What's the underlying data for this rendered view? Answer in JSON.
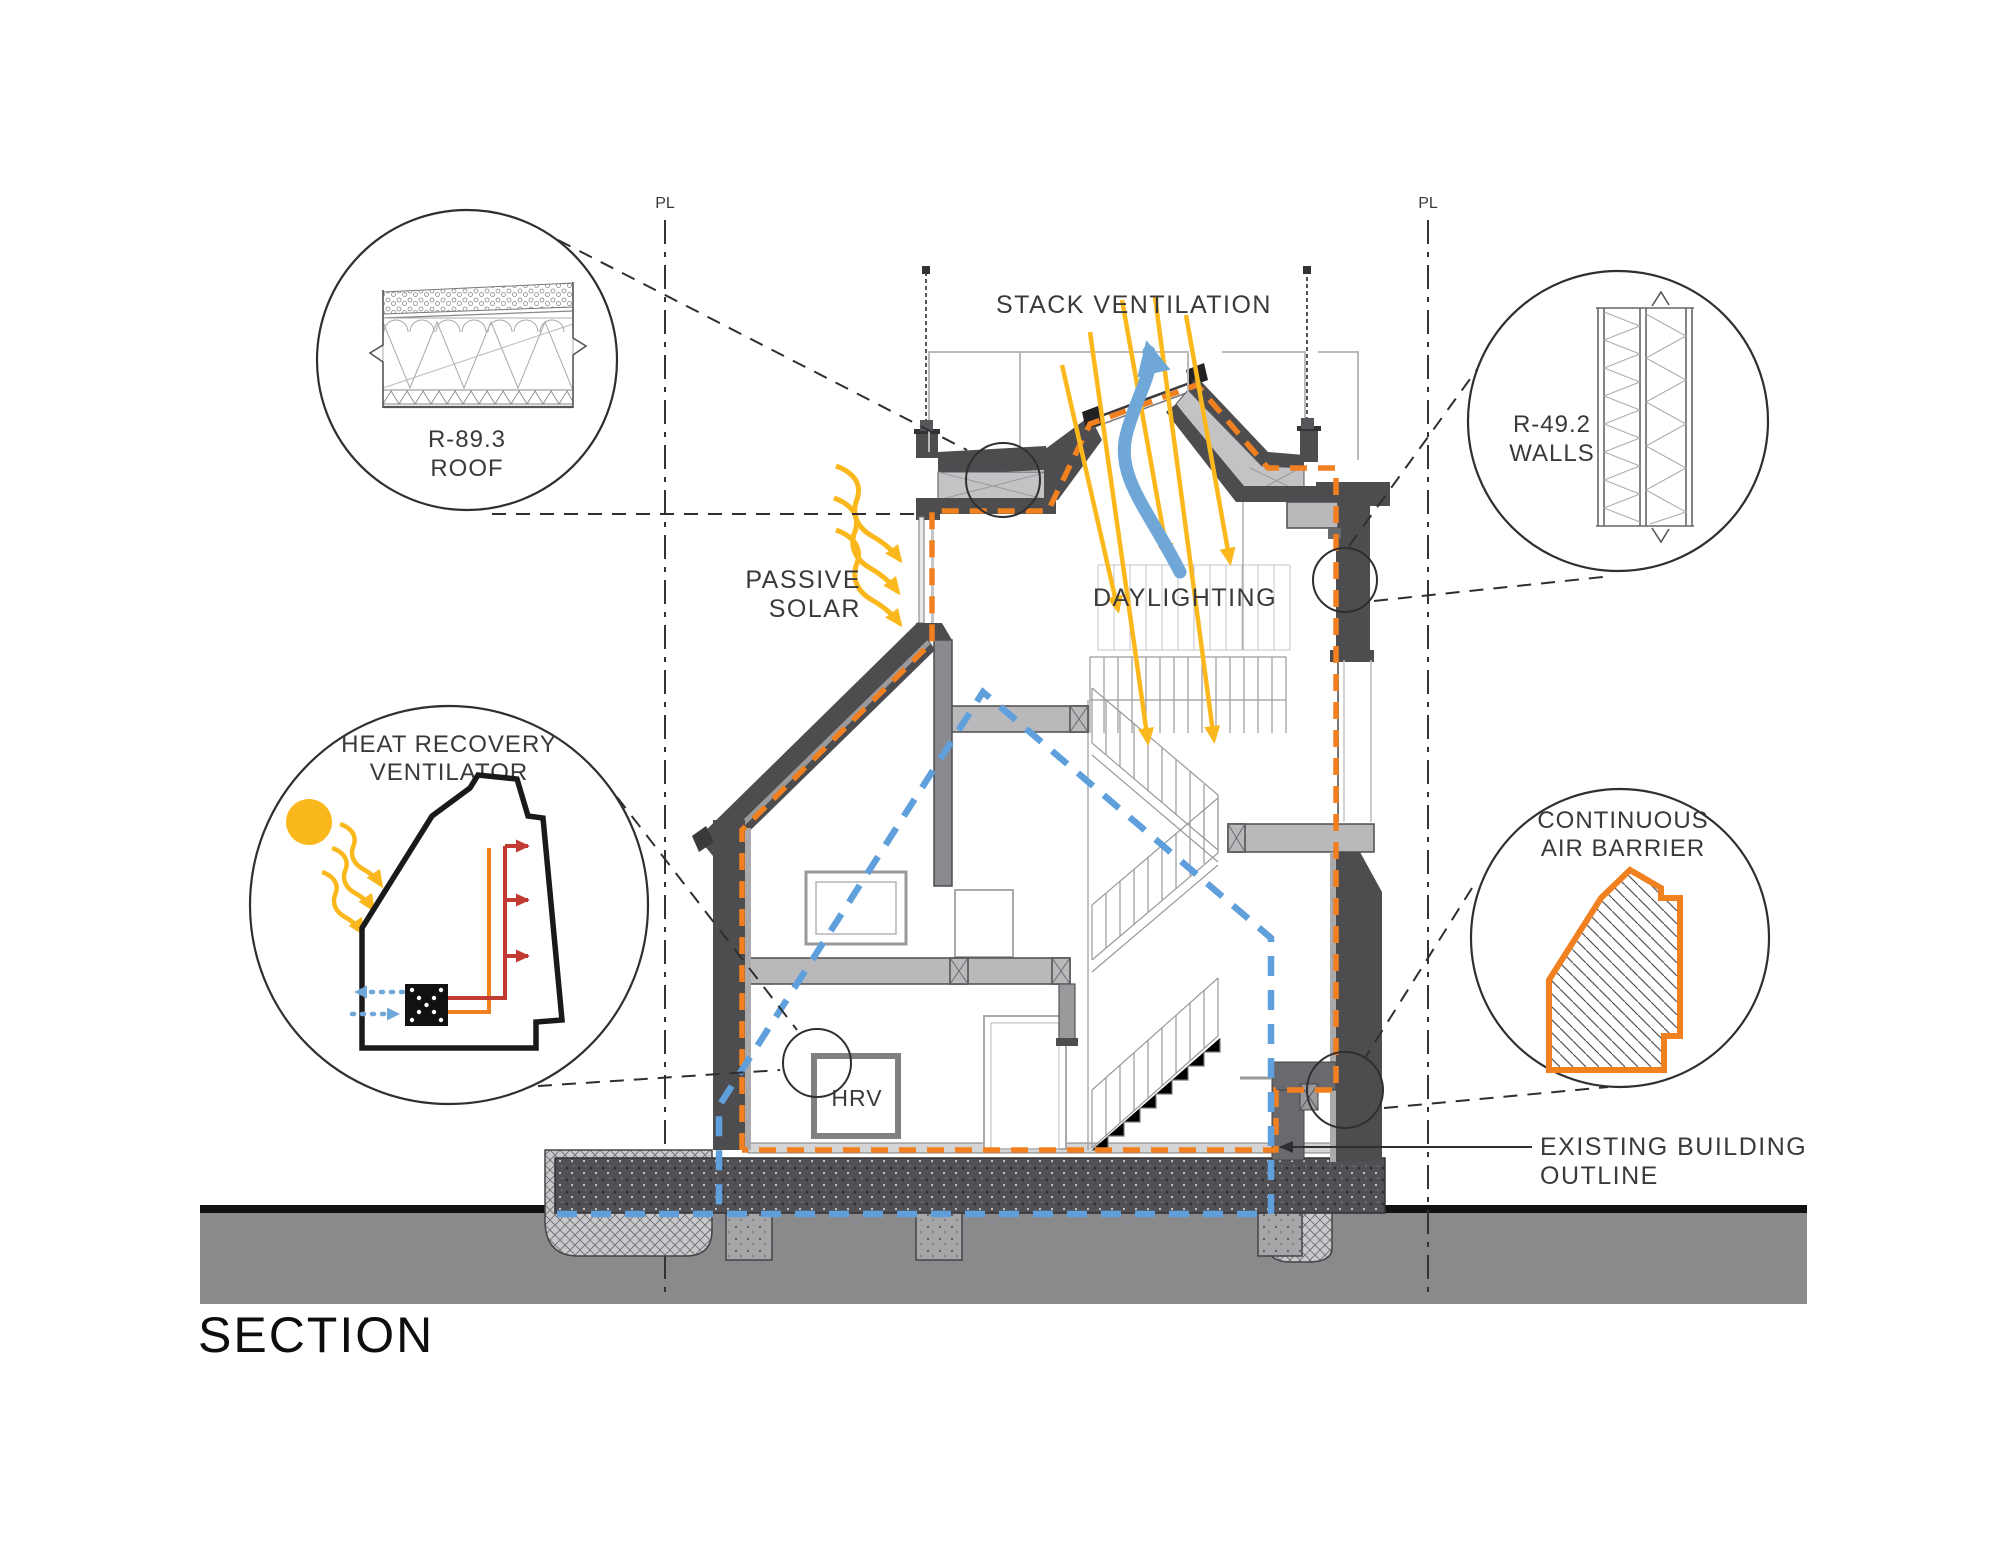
{
  "title": "SECTION",
  "property_line": {
    "label": "PL"
  },
  "annotations": {
    "stack_ventilation": "STACK VENTILATION",
    "passive_solar": {
      "line1": "PASSIVE",
      "line2": "SOLAR"
    },
    "daylighting": "DAYLIGHTING",
    "existing_building": {
      "line1": "EXISTING BUILDING",
      "line2": "OUTLINE"
    },
    "hrv_unit": "HRV"
  },
  "callouts": {
    "roof": {
      "line1": "R-89.3",
      "line2": "ROOF"
    },
    "walls": {
      "line1": "R-49.2",
      "line2": "WALLS"
    },
    "heat_recovery_ventilator": {
      "line1": "HEAT RECOVERY",
      "line2": "VENTILATOR"
    },
    "continuous_air_barrier": {
      "line1": "CONTINUOUS",
      "line2": "AIR BARRIER"
    }
  },
  "colors": {
    "air_barrier_orange": "#F08020",
    "existing_outline_blue": "#5FA0DC",
    "solar_yellow": "#FBB81C",
    "stack_arrow_blue": "#6FA8D8",
    "supply_red": "#C23B33",
    "wall_dark_gray": "#4d4d50",
    "ground_gray": "#8A8A8D"
  }
}
